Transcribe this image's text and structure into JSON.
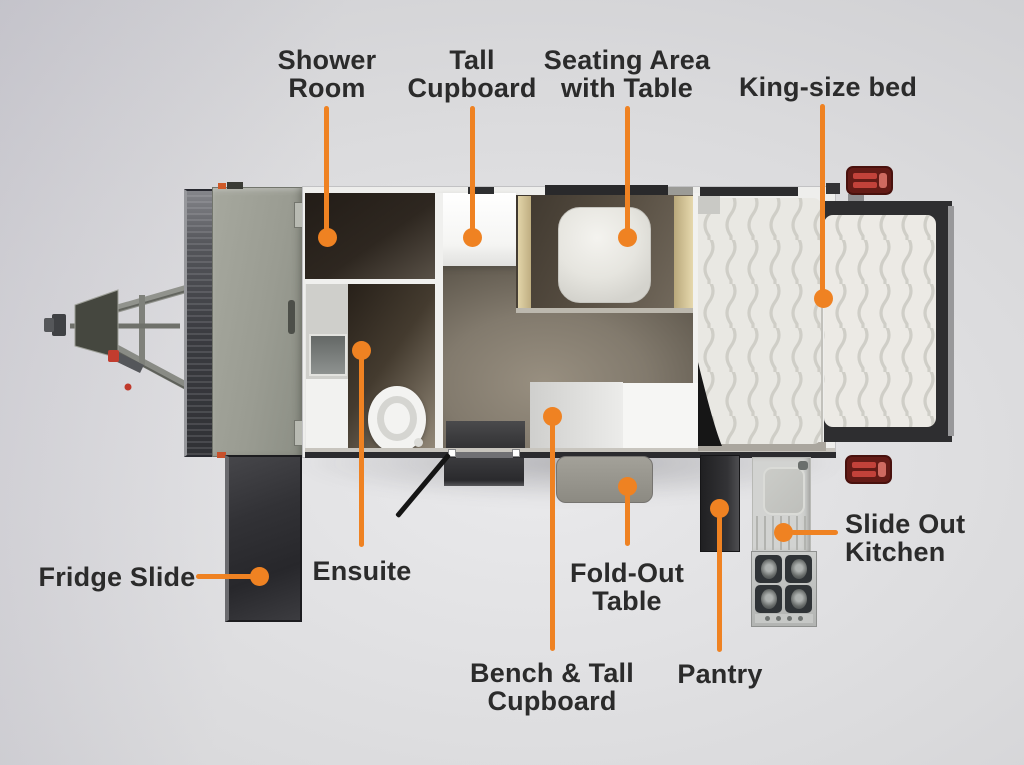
{
  "colors": {
    "accent": "#EF8222",
    "label_text": "#2B2B2B",
    "background": "#D2D2D5"
  },
  "diagram": {
    "type": "caravan-floorplan-top-view",
    "features": [
      "Shower Room",
      "Tall Cupboard",
      "Seating Area with Table",
      "King-size bed",
      "Fridge Slide",
      "Ensuite",
      "Fold-Out Table",
      "Bench & Tall Cupboard",
      "Pantry",
      "Slide Out Kitchen"
    ]
  },
  "callouts": {
    "shower_room": {
      "line1": "Shower",
      "line2": "Room"
    },
    "tall_cupboard": {
      "line1": "Tall",
      "line2": "Cupboard"
    },
    "seating_area": {
      "line1": "Seating Area",
      "line2": "with Table"
    },
    "king_size_bed": {
      "line1": "King-size bed"
    },
    "fridge_slide": {
      "line1": "Fridge Slide"
    },
    "ensuite": {
      "line1": "Ensuite"
    },
    "fold_out_table": {
      "line1": "Fold-Out",
      "line2": "Table"
    },
    "bench_tall_cupboard": {
      "line1": "Bench & Tall",
      "line2": "Cupboard"
    },
    "pantry": {
      "line1": "Pantry"
    },
    "slide_out_kitchen": {
      "line1": "Slide Out",
      "line2": "Kitchen"
    }
  }
}
